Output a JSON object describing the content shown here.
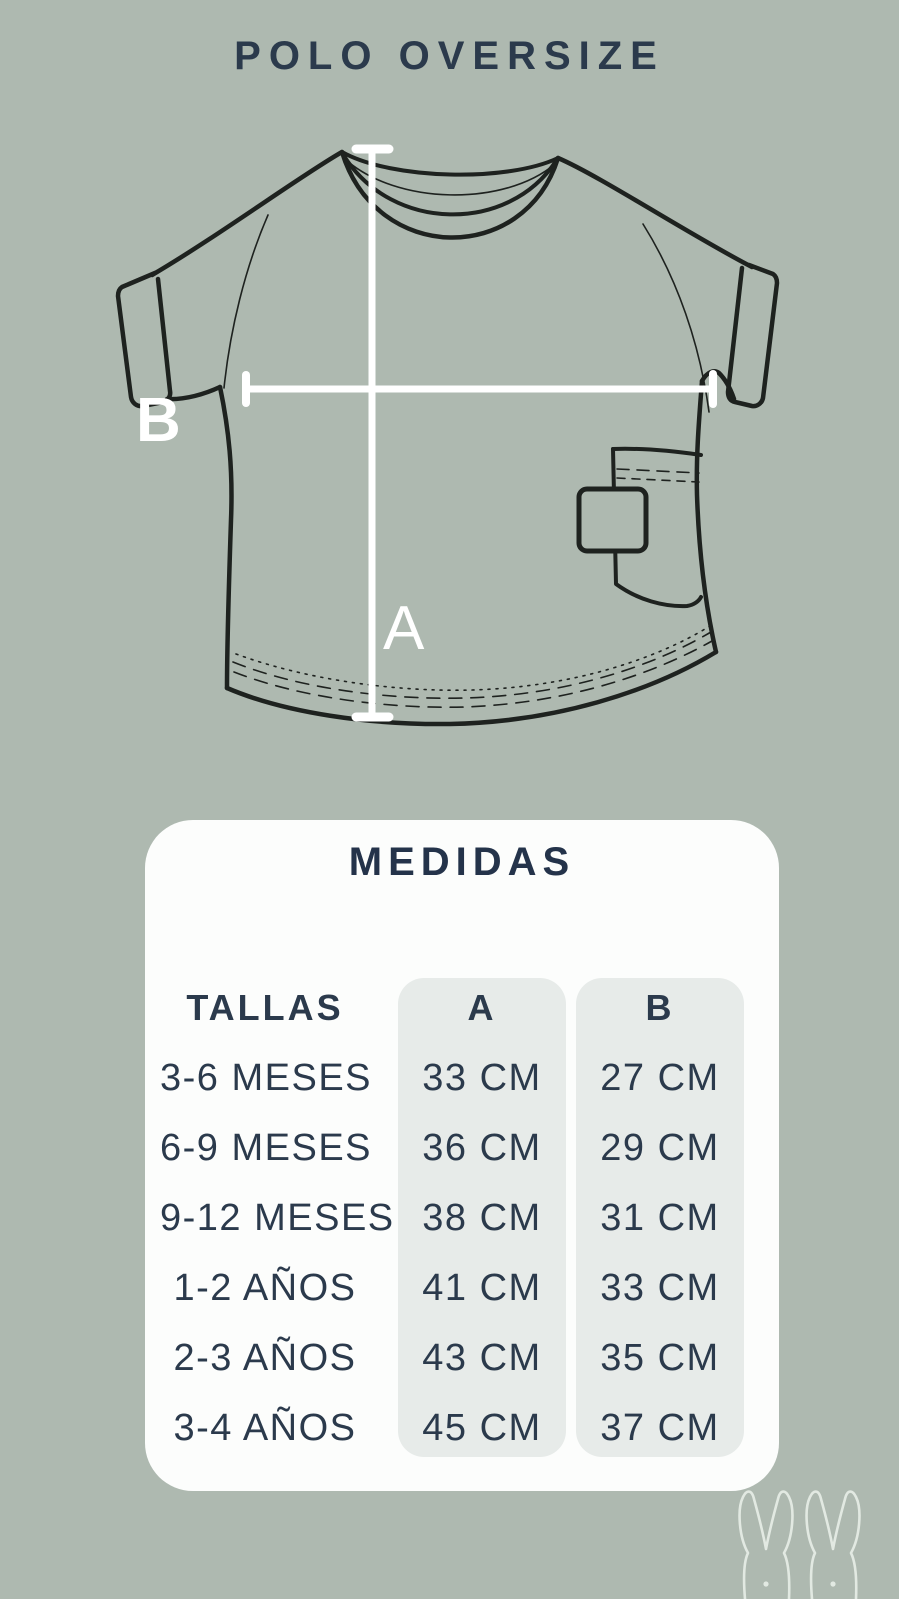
{
  "title": "POLO OVERSIZE",
  "diagram": {
    "height_label": "A",
    "width_label": "B"
  },
  "medidas": {
    "title": "MEDIDAS",
    "headers": {
      "sizes": "TALLAS",
      "col_a": "A",
      "col_b": "B"
    },
    "rows": [
      {
        "size": "3-6 MESES",
        "a": "33 CM",
        "b": "27 CM"
      },
      {
        "size": "6-9 MESES",
        "a": "36 CM",
        "b": "29 CM"
      },
      {
        "size": "9-12 MESES",
        "a": "38 CM",
        "b": "31 CM"
      },
      {
        "size": "1-2 AÑOS",
        "a": "41 CM",
        "b": "33 CM"
      },
      {
        "size": "2-3 AÑOS",
        "a": "43 CM",
        "b": "35 CM"
      },
      {
        "size": "3-4 AÑOS",
        "a": "45 CM",
        "b": "37 CM"
      }
    ]
  },
  "chart_data": {
    "type": "table",
    "title": "MEDIDAS",
    "columns": [
      "TALLAS",
      "A",
      "B"
    ],
    "rows": [
      [
        "3-6 MESES",
        "33 CM",
        "27 CM"
      ],
      [
        "6-9 MESES",
        "36 CM",
        "29 CM"
      ],
      [
        "9-12 MESES",
        "38 CM",
        "31 CM"
      ],
      [
        "1-2 AÑOS",
        "41 CM",
        "33 CM"
      ],
      [
        "2-3 AÑOS",
        "43 CM",
        "35 CM"
      ],
      [
        "3-4 AÑOS",
        "45 CM",
        "37 CM"
      ]
    ]
  },
  "colors": {
    "background": "#aeb9b0",
    "text_navy": "#2b3a4c",
    "card_white": "#fcfdfc",
    "column_gray": "#e7ebe9",
    "line_art": "#1e221f",
    "measure_line": "#ffffff"
  }
}
